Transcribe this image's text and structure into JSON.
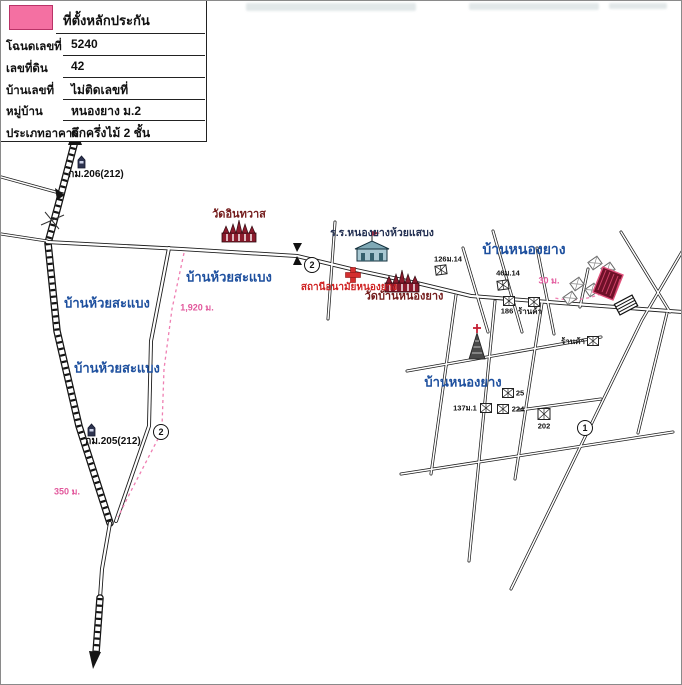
{
  "legend": {
    "title": "ที่ตั้งหลักประกัน",
    "swatch_color": "#f470a2",
    "rows": [
      {
        "label": "โฉนดเลขที่",
        "value": "5240"
      },
      {
        "label": "เลขที่ดิน",
        "value": "42"
      },
      {
        "label": "บ้านเลขที่",
        "value": "ไม่ติดเลขที่"
      },
      {
        "label": "หมู่บ้าน",
        "value": "หนองยาง ม.2"
      },
      {
        "label": "ประเภทอาคาร",
        "value": "ตึกครึ่งไม้ 2 ชั้น"
      }
    ]
  },
  "map": {
    "villages": [
      "บ้านห้วยสะแบง",
      "บ้านห้วยสะแบง",
      "บ้านห้วยสะแบง",
      "บ้านหนองยาง",
      "บ้านหนองยาง"
    ],
    "places": {
      "temple1": "วัดอินทวาส",
      "temple2": "วัดบ้านหนองยาง",
      "school": "ร.ร.หนองยางห้วยแสบง",
      "clinic": "สถานีอนามัยหนองยาง",
      "shop1": "ร้านค้า",
      "shop2": "ร้านค้า"
    },
    "km_markers": [
      "กม.206(212)",
      "กม.205(212)"
    ],
    "distances": [
      "1,920 ม.",
      "350 ม.",
      "30 ม."
    ],
    "house_numbers": [
      "126ม.14",
      "46ม.14",
      "186",
      "25",
      "224",
      "137ม.1",
      "202"
    ],
    "route_badges": [
      "2",
      "2",
      "1"
    ],
    "colors": {
      "village_label": "#1d4f9e",
      "temple_label": "#731b1b",
      "school_label": "#233052",
      "clinic_label": "#cf2222",
      "distance_label": "#e2589c",
      "collateral_fill": "#6f1128",
      "legend_swatch": "#f470a2"
    },
    "icons": {
      "temple_icon": "thai-temple",
      "school_icon": "school-building-flag",
      "clinic_icon": "red-cross",
      "church_icon": "church-spire-cross",
      "house_icon": "hatched-house",
      "km_post_icon": "kilometer-post",
      "arrow_icon": "road-direction-arrow",
      "bridge_icon": "bridge-culvert"
    }
  }
}
